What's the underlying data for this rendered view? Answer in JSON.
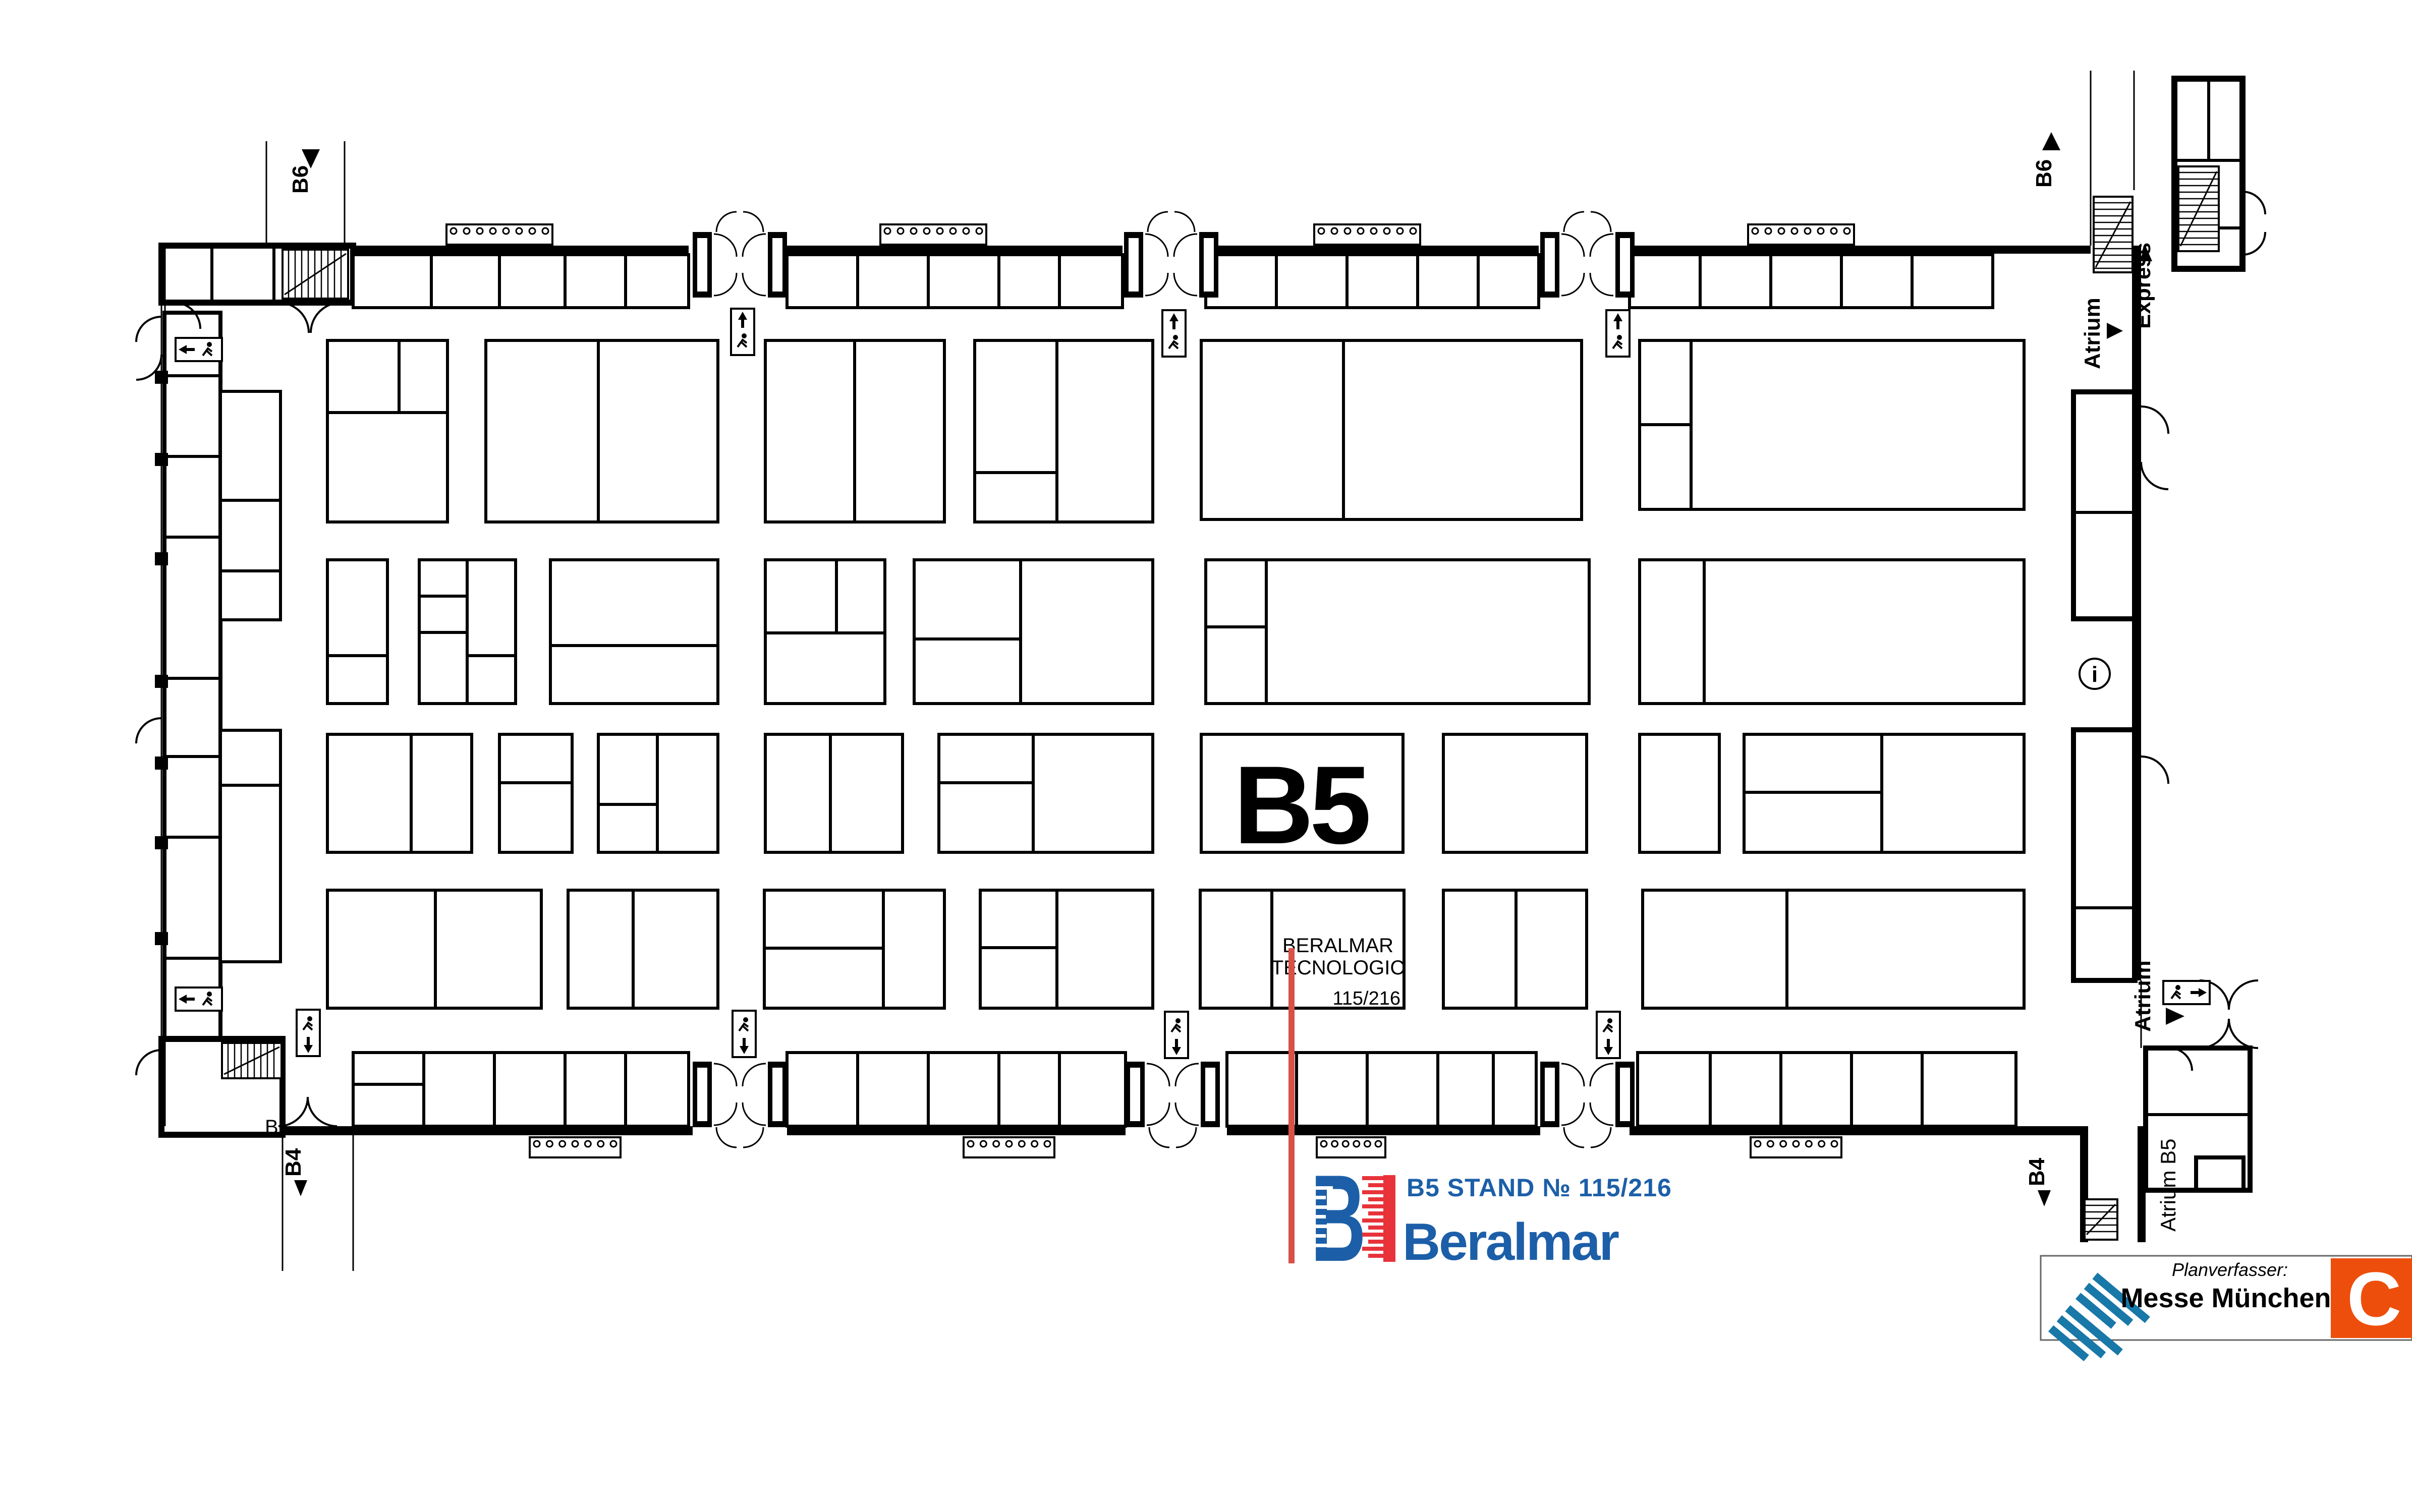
{
  "labels": {
    "hall": "B5",
    "b6": "B6",
    "b4": "B4",
    "atrium": "Atrium",
    "express": "Express",
    "atrium_b5": "Atrium B5",
    "wall_letter": "B",
    "info": "i"
  },
  "stand": {
    "name_line1": "BERALMAR",
    "name_line2": "TECNOLOGIC",
    "number": "115/216"
  },
  "callout": {
    "stand_label": "B5 STAND № 115/216",
    "brand": "Beralmar"
  },
  "planner": {
    "caption": "Planverfasser:",
    "name": "Messe München",
    "corner_letter": "C"
  },
  "colors": {
    "accent_red": "#d95049",
    "logo_red": "#e8333a",
    "brand_blue": "#1c5fa8",
    "messe_teal": "#1878a8",
    "corner_orange": "#ee4e0c",
    "plan_black": "#000000"
  },
  "floorplan": {
    "walls": [
      [
        700,
        487,
        665,
        16
      ],
      [
        1560,
        487,
        665,
        16
      ],
      [
        2390,
        487,
        660,
        16
      ],
      [
        3230,
        487,
        914,
        16
      ],
      [
        560,
        2233,
        813,
        18
      ],
      [
        1560,
        2233,
        671,
        18
      ],
      [
        2432,
        2233,
        621,
        18
      ],
      [
        3230,
        2233,
        893,
        18
      ],
      [
        4226,
        487,
        18,
        1457
      ],
      [
        4123,
        2233,
        16,
        230
      ],
      [
        4237,
        2233,
        16,
        230
      ]
    ],
    "rooms": [
      [
        320,
        487,
        380,
        113,
        12
      ],
      [
        4310,
        156,
        135,
        377,
        12
      ],
      [
        4110,
        777,
        122,
        450,
        10
      ],
      [
        4110,
        1447,
        122,
        497,
        10
      ],
      [
        320,
        2060,
        240,
        190,
        12
      ],
      [
        4253,
        2078,
        207,
        282,
        10
      ],
      [
        4353,
        2295,
        94,
        65,
        8
      ],
      [
        326,
        620,
        111,
        1440,
        8
      ]
    ],
    "stands": [
      [
        700,
        505,
        665,
        105
      ],
      [
        1560,
        505,
        665,
        105
      ],
      [
        2390,
        505,
        660,
        105
      ],
      [
        3230,
        505,
        720,
        105
      ],
      [
        649,
        675,
        238,
        360
      ],
      [
        963,
        675,
        460,
        360
      ],
      [
        1517,
        675,
        355,
        360
      ],
      [
        1932,
        675,
        353,
        360
      ],
      [
        2381,
        675,
        754,
        355
      ],
      [
        3250,
        675,
        762,
        335
      ],
      [
        649,
        1110,
        119,
        285
      ],
      [
        831,
        1110,
        191,
        285
      ],
      [
        1091,
        1110,
        332,
        285
      ],
      [
        1517,
        1110,
        237,
        285
      ],
      [
        1812,
        1110,
        473,
        285
      ],
      [
        2390,
        1110,
        760,
        285
      ],
      [
        3250,
        1110,
        762,
        285
      ],
      [
        649,
        1456,
        286,
        234
      ],
      [
        990,
        1456,
        144,
        234
      ],
      [
        1186,
        1456,
        237,
        234
      ],
      [
        1517,
        1456,
        272,
        234
      ],
      [
        1861,
        1456,
        424,
        234
      ],
      [
        2381,
        1456,
        400,
        234
      ],
      [
        2861,
        1456,
        284,
        234
      ],
      [
        3250,
        1456,
        158,
        234
      ],
      [
        3457,
        1456,
        555,
        234
      ],
      [
        649,
        1765,
        424,
        234
      ],
      [
        1126,
        1765,
        297,
        234
      ],
      [
        1515,
        1765,
        357,
        234
      ],
      [
        1943,
        1765,
        342,
        234
      ],
      [
        2379,
        1765,
        404,
        234
      ],
      [
        2861,
        1765,
        284,
        234
      ],
      [
        3256,
        1765,
        756,
        234
      ],
      [
        437,
        776,
        119,
        453
      ],
      [
        437,
        1448,
        119,
        459
      ],
      [
        700,
        2087,
        665,
        146
      ],
      [
        1560,
        2087,
        671,
        146
      ],
      [
        2432,
        2087,
        613,
        146
      ],
      [
        3246,
        2087,
        750,
        146
      ]
    ],
    "lines": [
      [
        855,
        505,
        855,
        610
      ],
      [
        990,
        505,
        990,
        610
      ],
      [
        1120,
        505,
        1120,
        610
      ],
      [
        1240,
        505,
        1240,
        610
      ],
      [
        1700,
        505,
        1700,
        610
      ],
      [
        1840,
        505,
        1840,
        610
      ],
      [
        1980,
        505,
        1980,
        610
      ],
      [
        2100,
        505,
        2100,
        610
      ],
      [
        2530,
        505,
        2530,
        610
      ],
      [
        2670,
        505,
        2670,
        610
      ],
      [
        2810,
        505,
        2810,
        610
      ],
      [
        2930,
        505,
        2930,
        610
      ],
      [
        3370,
        505,
        3370,
        610
      ],
      [
        3510,
        505,
        3510,
        610
      ],
      [
        3650,
        505,
        3650,
        610
      ],
      [
        3790,
        505,
        3790,
        610
      ],
      [
        649,
        818,
        887,
        818
      ],
      [
        791,
        675,
        791,
        818
      ],
      [
        1186,
        675,
        1186,
        1035
      ],
      [
        1694,
        675,
        1694,
        1035
      ],
      [
        2095,
        675,
        2095,
        1035
      ],
      [
        1932,
        937,
        2095,
        937
      ],
      [
        2663,
        675,
        2663,
        1030
      ],
      [
        3352,
        675,
        3352,
        1010
      ],
      [
        3250,
        842,
        3352,
        842
      ],
      [
        649,
        1300,
        768,
        1300
      ],
      [
        926,
        1110,
        926,
        1395
      ],
      [
        831,
        1182,
        926,
        1182
      ],
      [
        831,
        1254,
        926,
        1254
      ],
      [
        926,
        1300,
        1022,
        1300
      ],
      [
        1091,
        1280,
        1423,
        1280
      ],
      [
        1658,
        1110,
        1658,
        1255
      ],
      [
        1517,
        1255,
        1754,
        1255
      ],
      [
        2023,
        1110,
        2023,
        1395
      ],
      [
        1812,
        1267,
        2023,
        1267
      ],
      [
        2510,
        1110,
        2510,
        1395
      ],
      [
        2390,
        1243,
        2510,
        1243
      ],
      [
        3378,
        1110,
        3378,
        1395
      ],
      [
        815,
        1456,
        815,
        1690
      ],
      [
        990,
        1552,
        1134,
        1552
      ],
      [
        1303,
        1456,
        1303,
        1690
      ],
      [
        1186,
        1595,
        1303,
        1595
      ],
      [
        1646,
        1456,
        1646,
        1690
      ],
      [
        2048,
        1456,
        2048,
        1690
      ],
      [
        1861,
        1552,
        2048,
        1552
      ],
      [
        3730,
        1456,
        3730,
        1690
      ],
      [
        3457,
        1571,
        3730,
        1571
      ],
      [
        863,
        1765,
        863,
        1999
      ],
      [
        1255,
        1765,
        1255,
        1999
      ],
      [
        1751,
        1765,
        1751,
        1999
      ],
      [
        1515,
        1880,
        1751,
        1880
      ],
      [
        2095,
        1765,
        2095,
        1999
      ],
      [
        1943,
        1879,
        2095,
        1879
      ],
      [
        2521,
        1765,
        2521,
        1999
      ],
      [
        3005,
        1765,
        3005,
        1999
      ],
      [
        3542,
        1765,
        3542,
        1999
      ],
      [
        437,
        992,
        556,
        992
      ],
      [
        437,
        1132,
        556,
        1132
      ],
      [
        437,
        1557,
        556,
        1557
      ],
      [
        840,
        2087,
        840,
        2233
      ],
      [
        980,
        2087,
        980,
        2233
      ],
      [
        1120,
        2087,
        1120,
        2233
      ],
      [
        1240,
        2087,
        1240,
        2233
      ],
      [
        700,
        2150,
        840,
        2150
      ],
      [
        1700,
        2087,
        1700,
        2233
      ],
      [
        1840,
        2087,
        1840,
        2233
      ],
      [
        1980,
        2087,
        1980,
        2233
      ],
      [
        2100,
        2087,
        2100,
        2233
      ],
      [
        2570,
        2087,
        2570,
        2233
      ],
      [
        2710,
        2087,
        2710,
        2233
      ],
      [
        2850,
        2087,
        2850,
        2233
      ],
      [
        2960,
        2087,
        2960,
        2233
      ],
      [
        3390,
        2087,
        3390,
        2233
      ],
      [
        3530,
        2087,
        3530,
        2233
      ],
      [
        3670,
        2087,
        3670,
        2233
      ],
      [
        3810,
        2087,
        3810,
        2233
      ],
      [
        326,
        745,
        437,
        745
      ],
      [
        326,
        905,
        437,
        905
      ],
      [
        326,
        1065,
        437,
        1065
      ],
      [
        326,
        1345,
        437,
        1345
      ],
      [
        326,
        1500,
        437,
        1500
      ],
      [
        326,
        1660,
        437,
        1660
      ],
      [
        326,
        1900,
        437,
        1900
      ],
      [
        4110,
        1016,
        4232,
        1016
      ],
      [
        4110,
        1800,
        4232,
        1800
      ],
      [
        420,
        487,
        420,
        600
      ],
      [
        543,
        487,
        543,
        600
      ],
      [
        4310,
        318,
        4445,
        318
      ],
      [
        4310,
        452,
        4445,
        452
      ],
      [
        4378,
        156,
        4378,
        318
      ],
      [
        4253,
        2210,
        4460,
        2210
      ]
    ],
    "thin": [
      [
        320,
        487,
        320,
        2233
      ],
      [
        327,
        487,
        327,
        2233
      ],
      [
        528,
        280,
        528,
        487
      ],
      [
        683,
        280,
        683,
        487
      ],
      [
        4144,
        140,
        4144,
        487
      ],
      [
        4230,
        140,
        4230,
        377
      ],
      [
        560,
        2251,
        560,
        2520
      ],
      [
        700,
        2251,
        700,
        2520
      ],
      [
        4244,
        1944,
        4244,
        2078
      ]
    ],
    "paths": [
      "M345,600 A52,52 0 0 1 397,652",
      "M552,600 A60,60 0 0 1 612,660",
      "M676,600 A60,60 0 0 0 616,660",
      "M552,2233 A58,58 0 0 0 610,2175",
      "M668,2233 A58,58 0 0 1 610,2175",
      "M320,628 A50,50 0 0 0 270,678",
      "M320,703 A50,50 0 0 1 270,753",
      "M320,1424 A50,50 0 0 0 270,1474",
      "M320,2082 A50,50 0 0 0 270,2132",
      "M4244,806 A54,54 0 0 1 4298,860",
      "M4244,916 A54,54 0 0 0 4298,970",
      "M4244,1500 A54,54 0 0 1 4298,1554",
      "M4360,1944 A58,58 0 0 1 4418,2002",
      "M4476,1944 A58,58 0 0 0 4418,2002",
      "M4360,2078 A58,58 0 0 0 4418,2020",
      "M4476,2078 A58,58 0 0 1 4418,2020",
      "M4445,380 A45,45 0 0 1 4490,425",
      "M4445,505 A45,45 0 0 0 4490,460",
      "M4300,2078 A45,45 0 0 1 4345,2123"
    ],
    "pillars": [
      [
        307,
        735
      ],
      [
        307,
        898
      ],
      [
        307,
        1095
      ],
      [
        307,
        1338
      ],
      [
        307,
        1500
      ],
      [
        307,
        1658
      ],
      [
        307,
        1848
      ]
    ],
    "stairs": [
      [
        560,
        495,
        130,
        97,
        "v"
      ],
      [
        440,
        2068,
        118,
        70,
        "v"
      ],
      [
        4150,
        390,
        77,
        150,
        "h"
      ],
      [
        4318,
        330,
        80,
        168,
        "h"
      ],
      [
        4132,
        2378,
        65,
        80,
        "h"
      ]
    ],
    "combs": [
      [
        885,
        445,
        210,
        8
      ],
      [
        1745,
        445,
        210,
        8
      ],
      [
        2605,
        445,
        210,
        8
      ],
      [
        3465,
        445,
        210,
        8
      ],
      [
        1050,
        2255,
        180,
        7
      ],
      [
        1910,
        2255,
        180,
        7
      ],
      [
        2610,
        2255,
        136,
        6
      ],
      [
        3470,
        2255,
        180,
        7
      ]
    ],
    "vestibules": [
      [
        1373,
        460,
        "up"
      ],
      [
        2228,
        460,
        "up"
      ],
      [
        3053,
        460,
        "up"
      ],
      [
        1373,
        2105,
        "down"
      ],
      [
        2231,
        2105,
        "down"
      ],
      [
        3053,
        2105,
        "down"
      ]
    ],
    "exits": [
      [
        1449,
        612,
        "v",
        "up"
      ],
      [
        2304,
        615,
        "v",
        "up"
      ],
      [
        3184,
        615,
        "v",
        "up"
      ],
      [
        588,
        2002,
        "v",
        "down"
      ],
      [
        1452,
        2004,
        "v",
        "down"
      ],
      [
        2309,
        2006,
        "v",
        "down"
      ],
      [
        3165,
        2006,
        "v",
        "down"
      ],
      [
        348,
        670,
        "h",
        "left"
      ],
      [
        348,
        1958,
        "h",
        "left"
      ],
      [
        4288,
        1945,
        "h",
        "right"
      ]
    ]
  }
}
